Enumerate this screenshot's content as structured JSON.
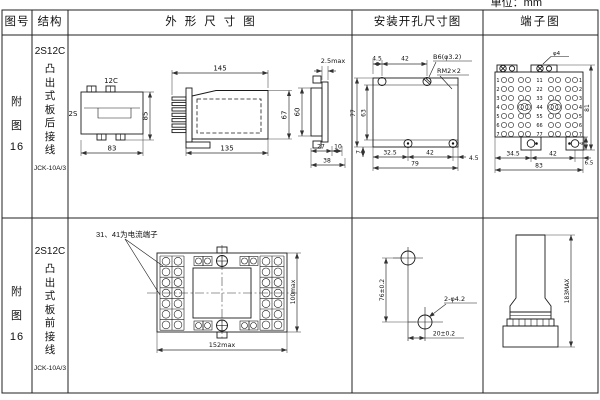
{
  "unit_label": "单位：mm",
  "header": {
    "fig_no": "图号",
    "structure": "结构",
    "outline": "外形尺寸图",
    "install": "安装开孔尺寸图",
    "terminal": "端子图"
  },
  "row1": {
    "fig": [
      "附",
      "图",
      "16"
    ],
    "model": "2S12C",
    "structure_desc": "凸出式板后接线",
    "code": "JCK-10A/3",
    "outline": {
      "top_width_label": "12C",
      "side_label": "2S",
      "height": "85",
      "width": "83",
      "length_total": "145",
      "length_body": "135",
      "body_height": "67",
      "panel_thickness": "2.5max",
      "front_height": "60",
      "depth_rear": "27",
      "depth_front": "10",
      "depth_total": "38"
    },
    "install": {
      "top_offset": "4.5",
      "top_span": "42",
      "hole_callout": "B6(φ3.2)",
      "screw_callout": "RM2×2",
      "height_total": "77",
      "height_inner": "63",
      "bottom_edge": "7",
      "bottom_left": "32.5",
      "bottom_span": "42",
      "bottom_right": "4.5",
      "width_total": "79"
    },
    "terminal": {
      "screw_callout": "φ4",
      "row_numbers": [
        "1",
        "2",
        "3",
        "4",
        "5",
        "6",
        "7"
      ],
      "pair_numbers": [
        "11",
        "22",
        "33",
        "44",
        "55",
        "66",
        "77"
      ],
      "dim_left": "34.5",
      "dim_mid": "42",
      "dim_right": "6.5",
      "dim_total": "83",
      "dim_height": "81",
      "dim_notch": "4"
    }
  },
  "row2": {
    "fig": [
      "附",
      "图",
      "16"
    ],
    "model": "2S12C",
    "structure_desc": "凸出式板前接线",
    "code": "JCK-10A/3",
    "outline": {
      "note": "31、41为电流端子",
      "height": "100max",
      "width": "152max"
    },
    "install": {
      "vertical": "76±0.2",
      "hole_callout": "2-φ4.2",
      "horizontal": "20±0.2"
    },
    "terminal": {
      "height": "183MAX"
    }
  }
}
